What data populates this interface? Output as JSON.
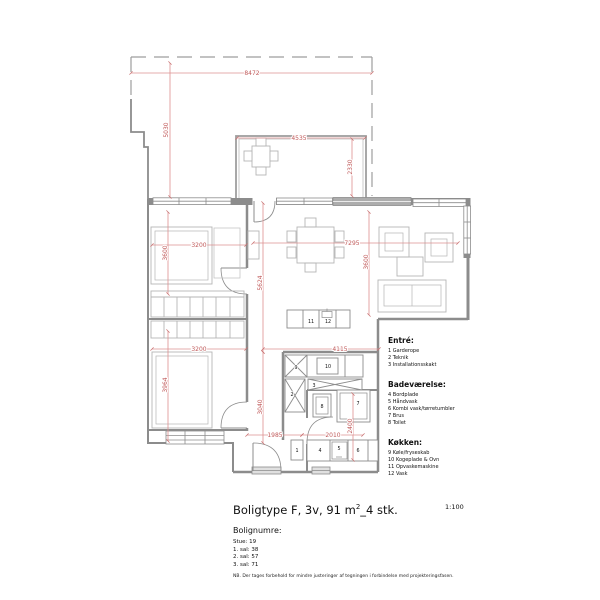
{
  "title": {
    "part1": "Boligtype F, 3v, 91 m",
    "sup": "2",
    "part2": "_4 stk.",
    "scale": "1:100"
  },
  "legend": {
    "sections": [
      {
        "heading": "Entré:",
        "items": [
          "1 Garderope",
          "2 Teknik",
          "3 Installationsskakt"
        ]
      },
      {
        "heading": "Badeværelse:",
        "items": [
          "4 Bordplade",
          "5 Håndvask",
          "6 Kombi vask/tørretumbler",
          "7 Brus",
          "8 Toilet"
        ]
      },
      {
        "heading": "Køkken:",
        "items": [
          "9 Køle/fryseskab",
          "10 Kogeplade & Ovn",
          "11 Opvaskemaskine",
          "12 Vask"
        ]
      }
    ]
  },
  "bolignumre": {
    "heading": "Bolignumre:",
    "items": [
      "Stue: 19",
      "1. sal: 38",
      "2. sal: 57",
      "3. sal: 71"
    ]
  },
  "note": "NB. Der tages forbehold for mindre justeringer af tegningen i forbindelse med projekteringsfasen.",
  "plan": {
    "dims": {
      "d8472": "8472",
      "d5030": "5030",
      "d4535": "4535",
      "d2330": "2330",
      "d3200a": "3200",
      "d3600a": "3600",
      "d7295": "7295",
      "d3600b": "3600",
      "d5624": "5624",
      "d3040": "3040",
      "d3200b": "3200",
      "d3964": "3964",
      "d4115": "4115",
      "d1985": "1985",
      "d2010": "2010",
      "d2400": "2400"
    },
    "fixtures": {
      "f1": "1",
      "f2": "2",
      "f3": "3",
      "f4": "4",
      "f5": "5",
      "f6": "6",
      "f7": "7",
      "f8": "8",
      "f9": "9",
      "f10": "10",
      "f11": "11",
      "f12": "12"
    },
    "colors": {
      "dimension_red": "#c05a5a",
      "wall_gray": "#8c8c8c",
      "furniture_gray": "#b5b5b5"
    }
  }
}
